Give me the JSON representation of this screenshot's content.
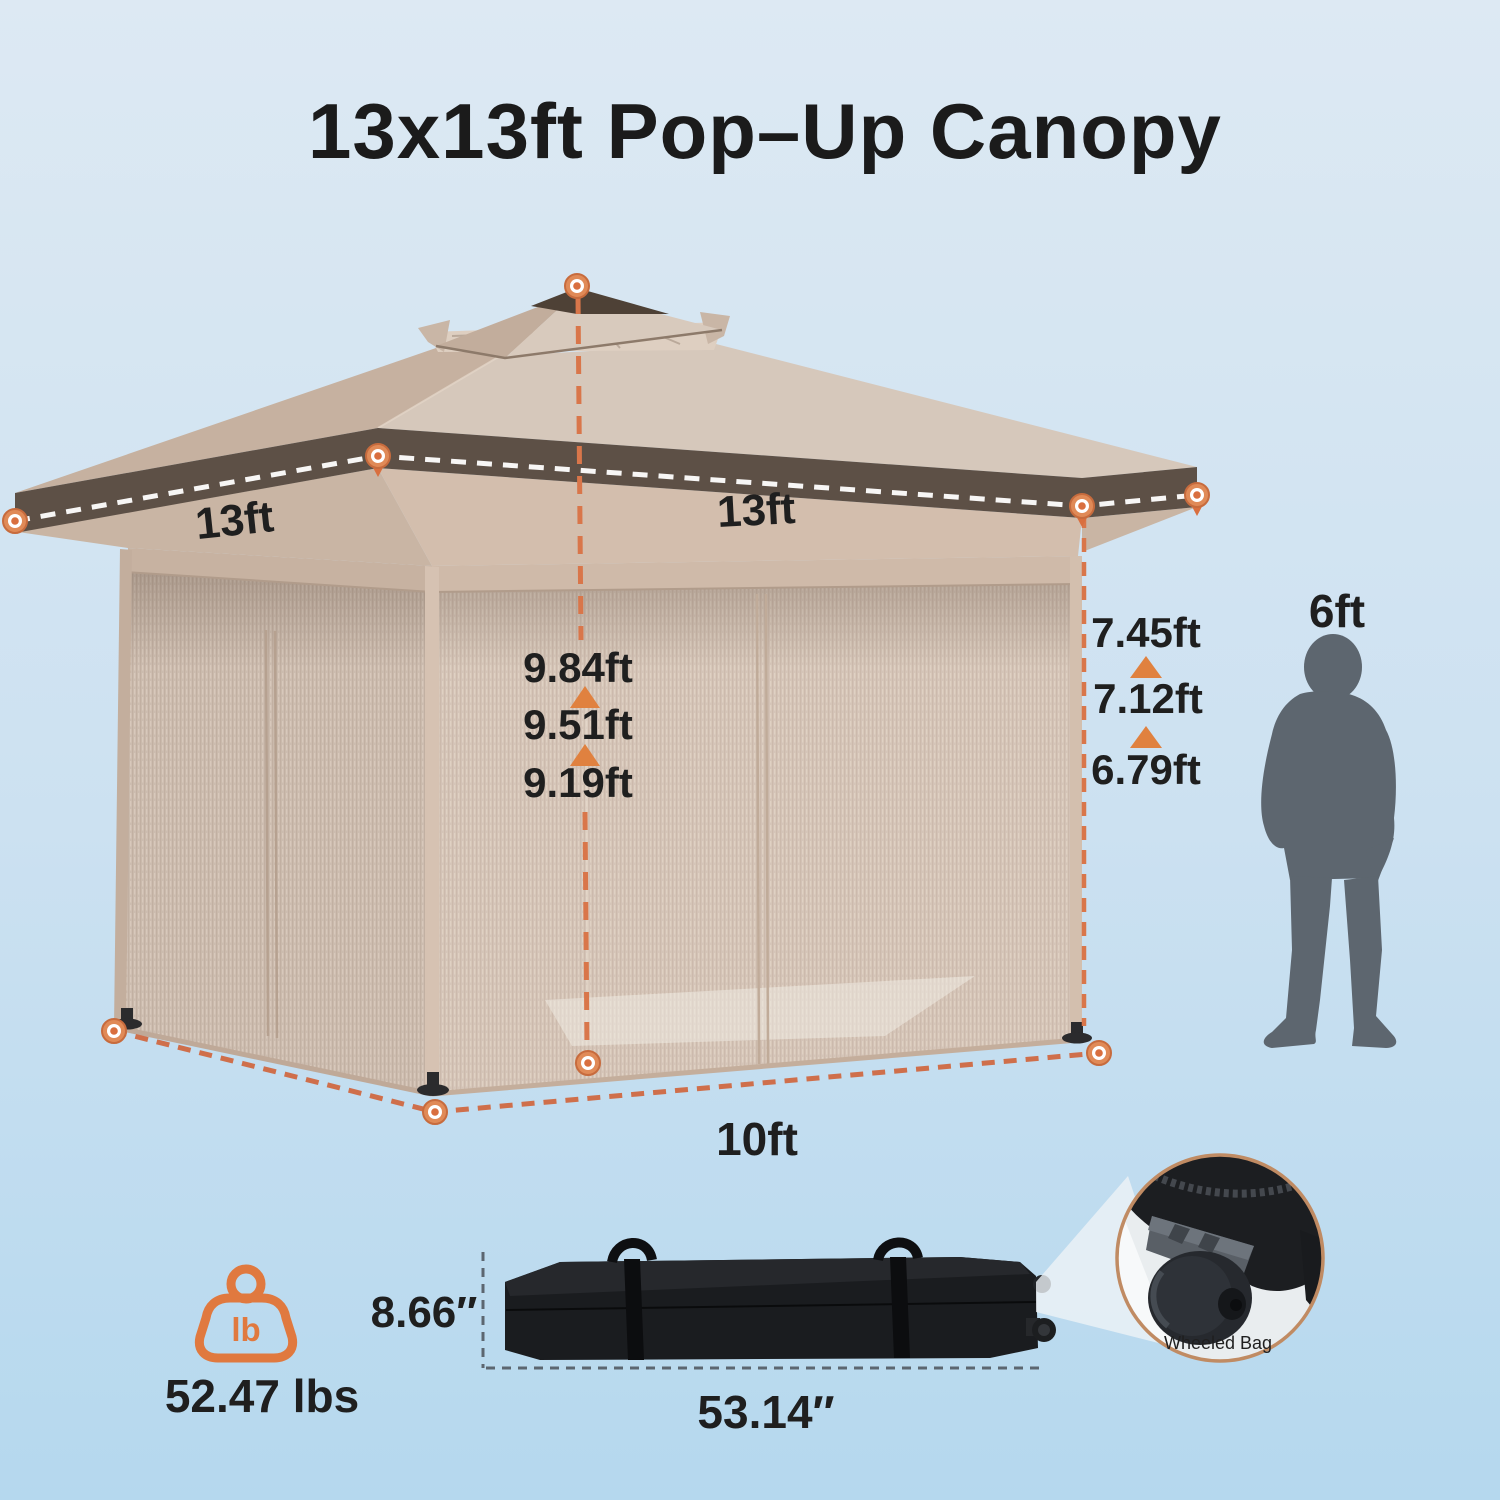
{
  "title": "13x13ft Pop–Up Canopy",
  "canopy": {
    "left_width": "13ft",
    "front_width": "13ft",
    "peak_heights": [
      "9.84ft",
      "9.51ft",
      "9.19ft"
    ],
    "eave_heights": [
      "7.45ft",
      "7.12ft",
      "6.79ft"
    ],
    "base_depth": "10ft"
  },
  "person": {
    "height": "6ft"
  },
  "weight": {
    "value": "52.47 lbs",
    "icon_text": "lb"
  },
  "bag": {
    "height": "8.66″",
    "length": "53.14″",
    "callout": "Wheeled Bag"
  },
  "colors": {
    "background_top": "#DDE9F3",
    "background_bottom": "#B5D8EE",
    "accent_orange": "#E0813F",
    "dash_orange": "#D9764A",
    "roof_tan": "#D6C8BB",
    "fascia_brown": "#5D5046",
    "mesh_tan": "#D5C5B8",
    "silhouette_gray": "#5D666F",
    "bag_black": "#1A1C1F",
    "inset_ring": "#C08B63"
  }
}
